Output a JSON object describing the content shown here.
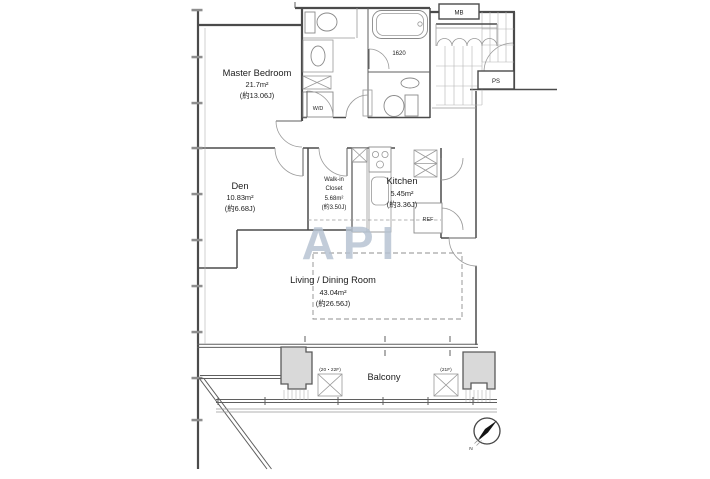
{
  "plan": {
    "rooms": {
      "master_bedroom": {
        "name": "Master Bedroom",
        "area": "21.7m²",
        "tatami": "(約13.06J)"
      },
      "den": {
        "name": "Den",
        "area": "10.83m²",
        "tatami": "(約6.68J)"
      },
      "walk_in_closet": {
        "name_line1": "Walk-in",
        "name_line2": "Closet",
        "area": "5.68m²",
        "tatami": "(約3.50J)"
      },
      "kitchen": {
        "name": "Kitchen",
        "area": "5.45m²",
        "tatami": "(約3.36J)"
      },
      "living_dining": {
        "name": "Living / Dining Room",
        "area": "43.04m²",
        "tatami": "(約26.56J)"
      },
      "balcony": {
        "name": "Balcony",
        "floor_note_left": "(20・22F)",
        "floor_note_right": "(21F)"
      }
    },
    "labels": {
      "washer_dryer": "W/D",
      "bathtub_size": "1620",
      "meter_box": "MB",
      "pipe_shaft": "PS",
      "refrigerator": "REF",
      "compass_north": "N"
    },
    "watermark": {
      "text": "API"
    },
    "colors": {
      "walls": "#4b4b4b",
      "thin_lines": "#999999",
      "pillar_fill": "#d9d9d9",
      "watermark": "#b5c2d1",
      "background": "#ffffff"
    }
  }
}
